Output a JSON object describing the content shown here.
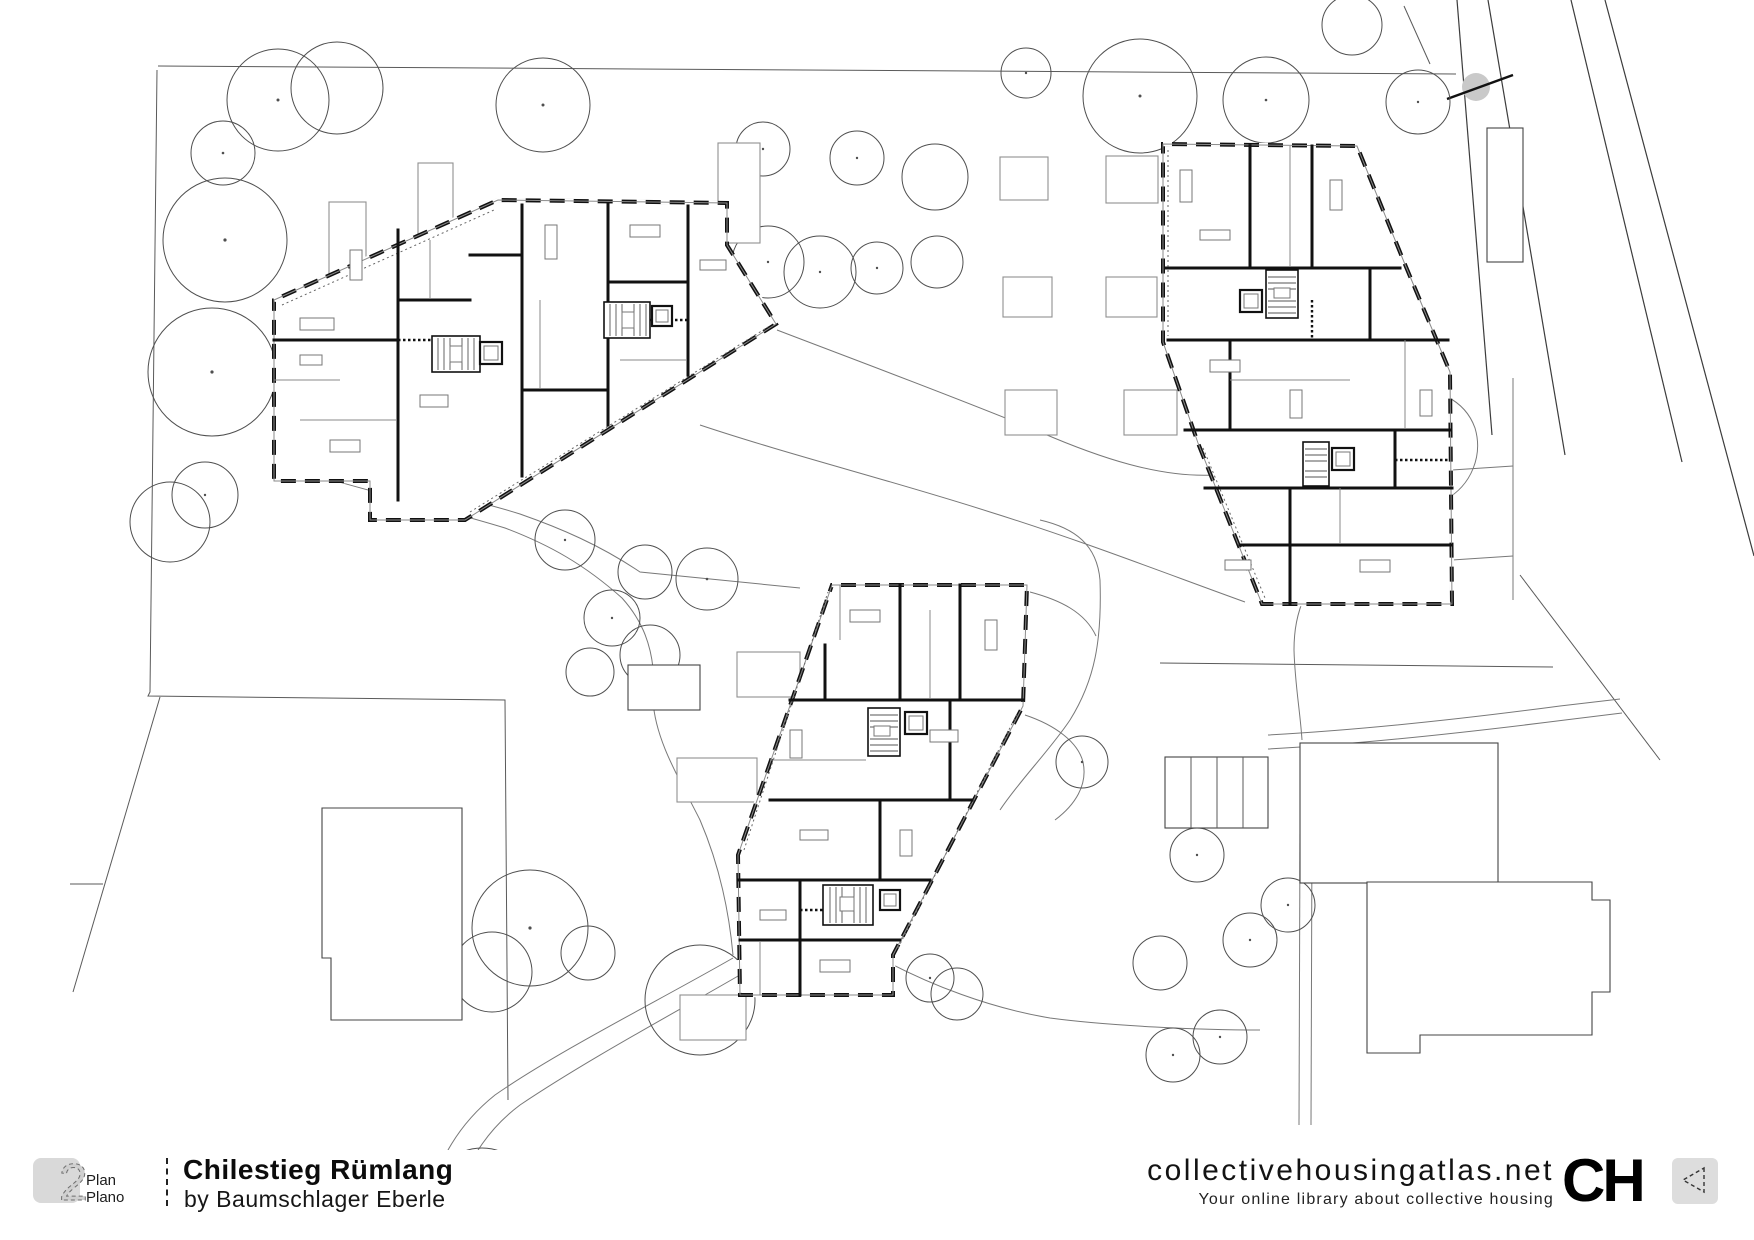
{
  "footer": {
    "plan_badge": {
      "number": "2",
      "label_line1": "Plan",
      "label_line2": "Plano"
    },
    "title_block": {
      "project_title": "Chilestieg Rümlang",
      "project_byline": "by Baumschlager Eberle"
    },
    "brand": {
      "site_name": "collectivehousingatlas.net",
      "site_tagline": "Your online library about collective housing",
      "logo_text": "CH"
    }
  },
  "drawing": {
    "description": "Black-and-white architectural site plan: three polygonal apartment buildings with internal walls and stair cores, surrounded by trees, footpaths, garages, neighbouring buildings and diagonal access roads",
    "buildings_count": 3
  },
  "colors": {
    "background": "#ffffff",
    "line_dark": "#111111",
    "line_mid": "#555555",
    "line_light": "#8a8a8a",
    "badge_bg": "#d9d9d9",
    "icon_box_bg": "#dddddd",
    "survey_marker_fill": "#c9c9c9"
  }
}
